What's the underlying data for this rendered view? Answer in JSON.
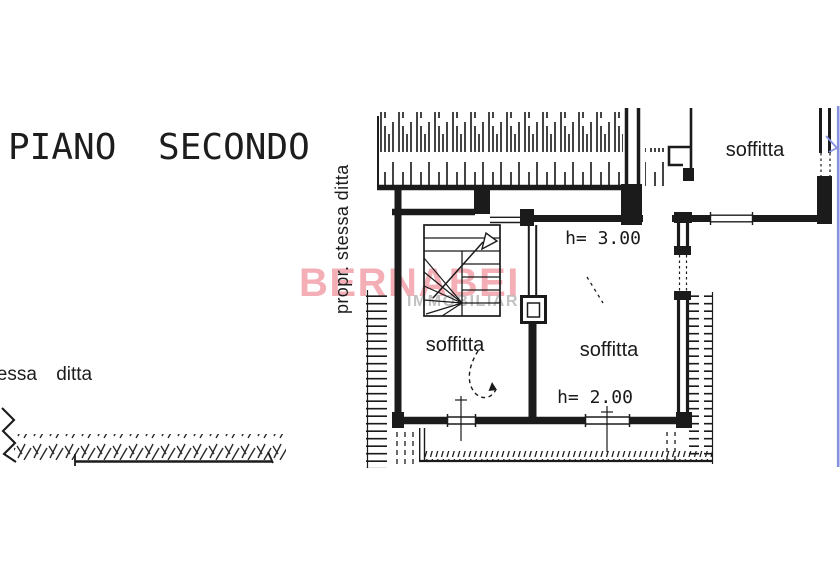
{
  "colors": {
    "background": "#ffffff",
    "ink": "#1b1b1b",
    "watermark_pink": "#f2a7b0",
    "watermark_gray": "#bdbdbd",
    "annotation_blue": "#8591de"
  },
  "header": {
    "floor_title": "PIANO SECONDO"
  },
  "notes": {
    "vertical_property_note": "propr. stessa ditta",
    "left_property_note": "stessa ditta"
  },
  "plan": {
    "room_labels": [
      {
        "label": "soffitta",
        "location": "top-right-wing"
      },
      {
        "label": "soffitta",
        "location": "left-room"
      },
      {
        "label": "soffitta",
        "location": "right-room"
      }
    ],
    "height_annotations": [
      {
        "label": "h= 3.00",
        "location": "upper-room"
      },
      {
        "label": "h= 2.00",
        "location": "lower-room"
      }
    ]
  },
  "watermark": {
    "agency": "BERNABEI",
    "tagline": "IMMOBILIARE"
  }
}
